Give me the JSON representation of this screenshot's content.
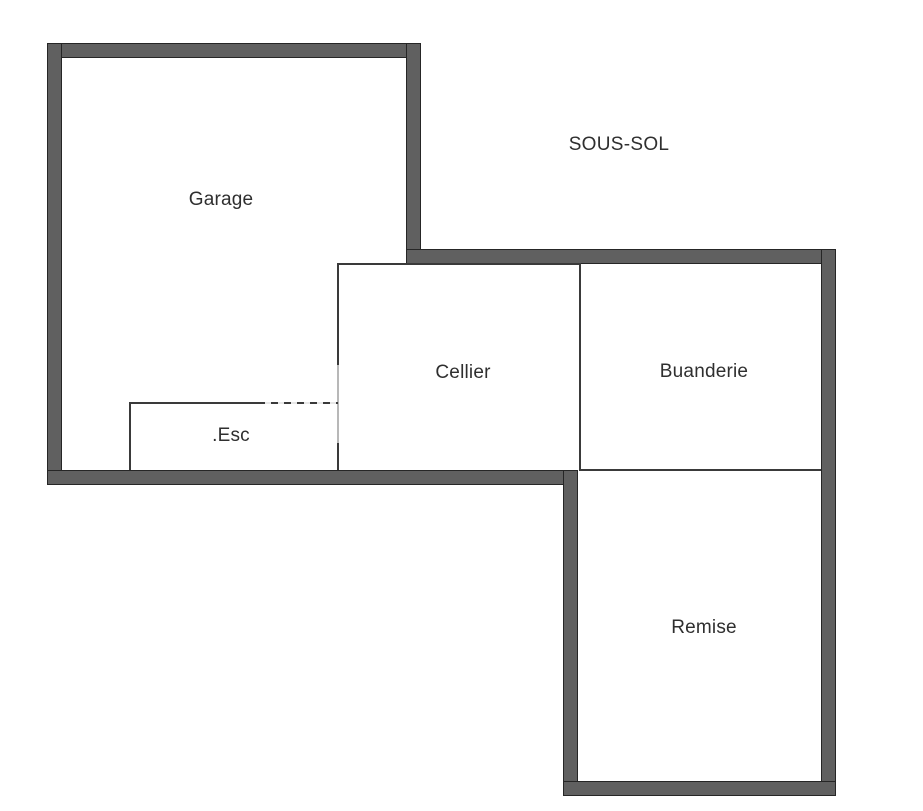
{
  "plan": {
    "title": "SOUS-SOL",
    "rooms": {
      "garage": "Garage",
      "cellier": "Cellier",
      "buanderie": "Buanderie",
      "esc": ".Esc",
      "remise": "Remise"
    },
    "colors": {
      "wall_fill": "#606060",
      "wall_edge": "#262626",
      "partition_line": "#3a3a3a",
      "partition_line_light": "#b8b8b8",
      "background": "#ffffff",
      "label_text": "#2f2f2f"
    }
  }
}
